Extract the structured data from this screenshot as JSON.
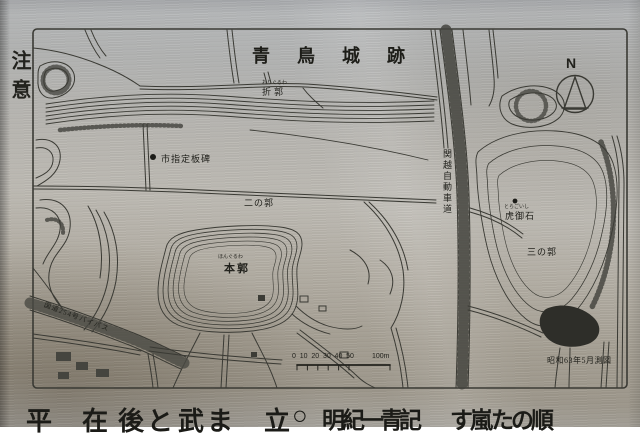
{
  "plaque": {
    "left_edge_text": "注意",
    "bottom_chars": [
      "平",
      "在",
      "後",
      "と",
      "武",
      "ま",
      "立",
      "○",
      "明",
      "紀",
      "一",
      "青",
      "記",
      "す",
      "嵐",
      "た",
      "の",
      "順"
    ]
  },
  "map": {
    "title": "青鳥城跡",
    "compass_label": "N",
    "survey_note": "昭和63年5月測図",
    "labels": {
      "ori_kuruwa": {
        "furigana": "おりぐるわ",
        "text": "折郭"
      },
      "itahi": "市指定板碑",
      "ni_no_kuruwa": "二の郭",
      "hon_kuruwa": {
        "furigana": "ほんぐるわ",
        "text": "本郭"
      },
      "kanetsu_expressway": "関越自動車道",
      "tora_go_ishi": {
        "furigana": "とらごいし",
        "text": "虎御石"
      },
      "san_no_kuruwa": "三の郭",
      "route254_bypass": "国道254号バイパス"
    },
    "scale_bar": {
      "numbers": [
        "0",
        "10",
        "20",
        "30",
        "40",
        "50"
      ],
      "end_label": "100m"
    }
  },
  "colors": {
    "metal": "#b2b2af",
    "line": "#3a3a34",
    "text": "#1f1f1b"
  }
}
